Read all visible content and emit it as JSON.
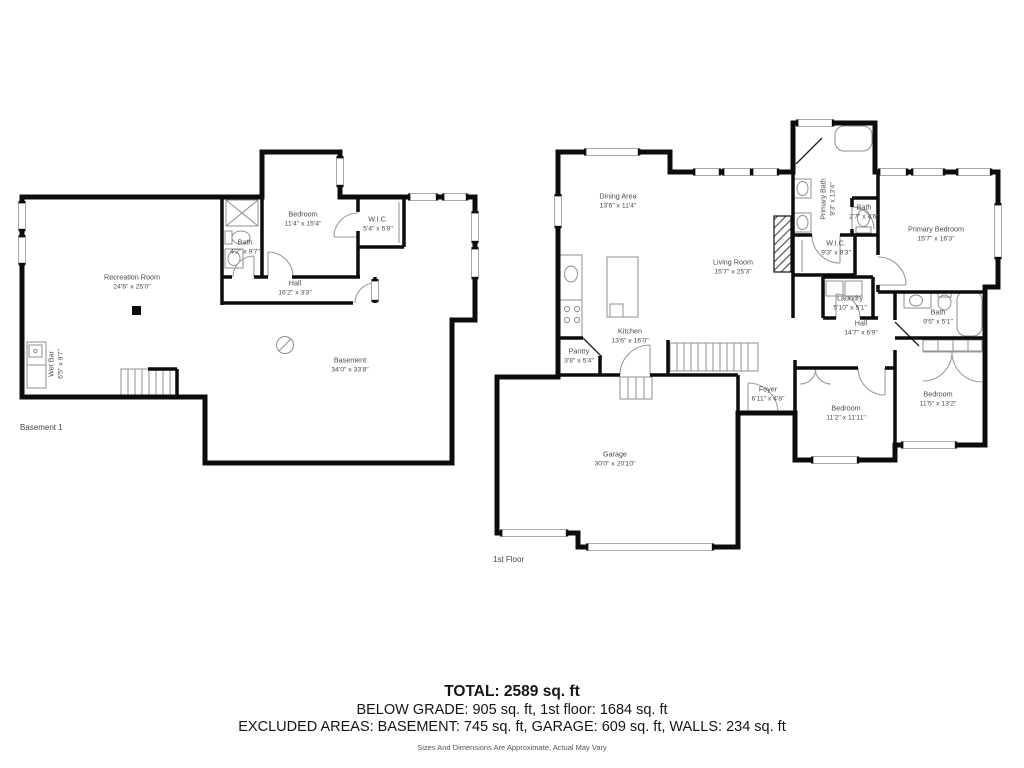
{
  "floors": {
    "basement": {
      "caption": "Basement 1",
      "rooms": {
        "recreation": {
          "name": "Recreation Room",
          "dims": "24'6\" x 25'0\""
        },
        "bedroom": {
          "name": "Bedroom",
          "dims": "11'4\" x 15'4\""
        },
        "wic": {
          "name": "W.I.C.",
          "dims": "5'4\" x 5'8\""
        },
        "bath": {
          "name": "Bath",
          "dims": "4'2\" x 9'7\""
        },
        "hall": {
          "name": "Hall",
          "dims": "16'2\" x 3'3\""
        },
        "wetbar": {
          "name": "Wet Bar",
          "dims": "6'5\" x 9'7\""
        },
        "basement": {
          "name": "Basement",
          "dims": "34'0\" x 33'8\""
        }
      }
    },
    "first": {
      "caption": "1st Floor",
      "rooms": {
        "dining": {
          "name": "Dining Area",
          "dims": "13'6\" x 11'4\""
        },
        "living": {
          "name": "Living Room",
          "dims": "15'7\" x 25'3\""
        },
        "kitchen": {
          "name": "Kitchen",
          "dims": "13'6\" x 16'0\""
        },
        "pantry": {
          "name": "Pantry",
          "dims": "3'8\" x 5'4\""
        },
        "primary_bath": {
          "name": "Primary Bath",
          "dims": "9'3\" x 13'4\""
        },
        "bath_small": {
          "name": "Bath",
          "dims": "2'7\" x 4'6\""
        },
        "wic": {
          "name": "W.I.C.",
          "dims": "9'3\" x 8'3\""
        },
        "primary_bedroom": {
          "name": "Primary Bedroom",
          "dims": "15'7\" x 16'3\""
        },
        "laundry": {
          "name": "Laundry",
          "dims": "5'10\" x 5'1\""
        },
        "hall": {
          "name": "Hall",
          "dims": "14'7\" x 6'9\""
        },
        "bath": {
          "name": "Bath",
          "dims": "9'5\" x 5'1\""
        },
        "bedroom_right": {
          "name": "Bedroom",
          "dims": "11'5\" x 13'2\""
        },
        "bedroom_left": {
          "name": "Bedroom",
          "dims": "11'2\" x 11'11\""
        },
        "foyer": {
          "name": "Foyer",
          "dims": "6'11\" x 4'8\""
        },
        "garage": {
          "name": "Garage",
          "dims": "30'0\" x 20'10\""
        }
      }
    }
  },
  "footer": {
    "total": "TOTAL: 2589 sq. ft",
    "below_grade": "BELOW GRADE: 905 sq. ft, 1st floor: 1684 sq. ft",
    "excluded": "EXCLUDED AREAS: BASEMENT: 745 sq. ft, GARAGE: 609 sq. ft, WALLS: 234 sq. ft",
    "disclaimer": "Sizes And Dimensions Are Approximate, Actual May Vary"
  },
  "colors": {
    "wall": "#0c0c0c",
    "fixture": "#8f8f8f",
    "label": "#4a4a4a"
  }
}
